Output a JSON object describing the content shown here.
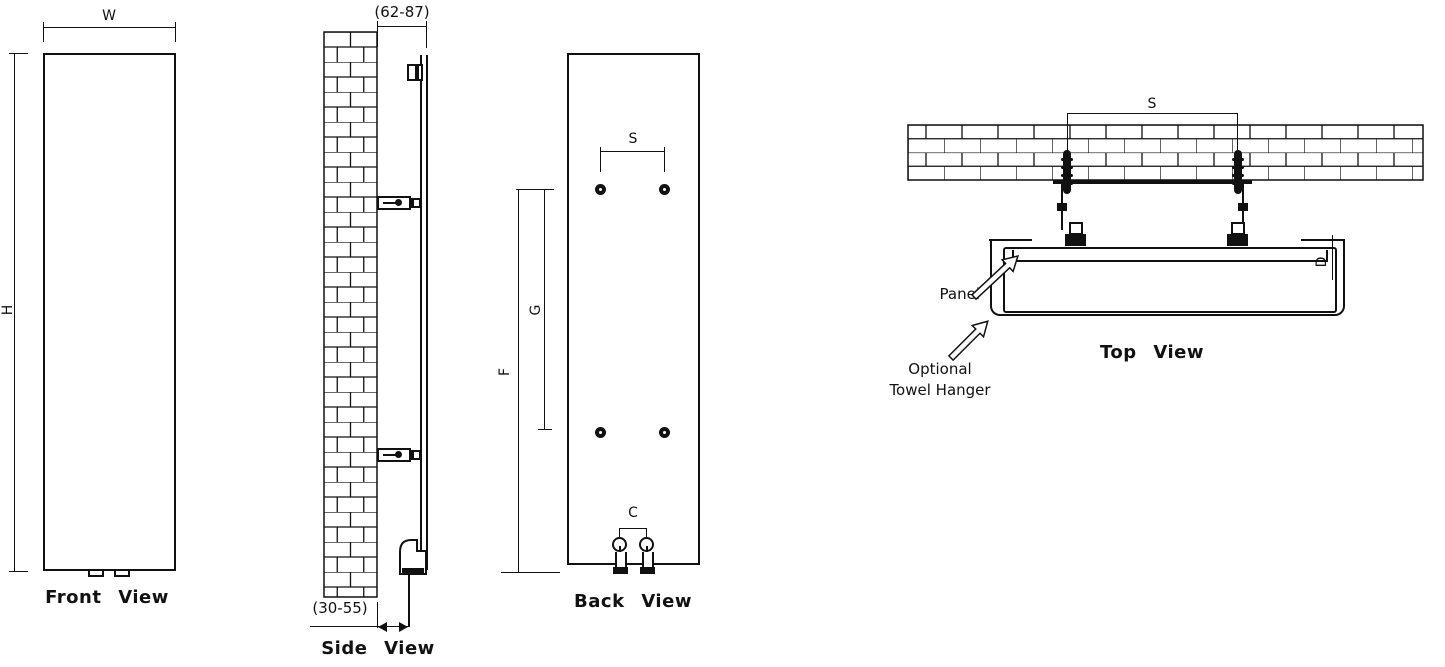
{
  "front_view": {
    "title": "Front View",
    "width_dim": "W",
    "height_dim": "H"
  },
  "side_view": {
    "title": "Side View",
    "wall_gap_dim": "(62-87)",
    "pipe_gap_dim": "(30-55)"
  },
  "back_view": {
    "title": "Back View",
    "bracket_span_dim": "S",
    "upper_height_dim": "G",
    "total_height_dim": "F",
    "pipe_span_dim": "C"
  },
  "top_view": {
    "title": "Top View",
    "bracket_span_dim": "S",
    "depth_dim": "D",
    "panel_label": "Panel",
    "hanger_label_line1": "Optional",
    "hanger_label_line2": "Towel Hanger"
  },
  "colors": {
    "line": "#111111",
    "background": "#ffffff"
  }
}
